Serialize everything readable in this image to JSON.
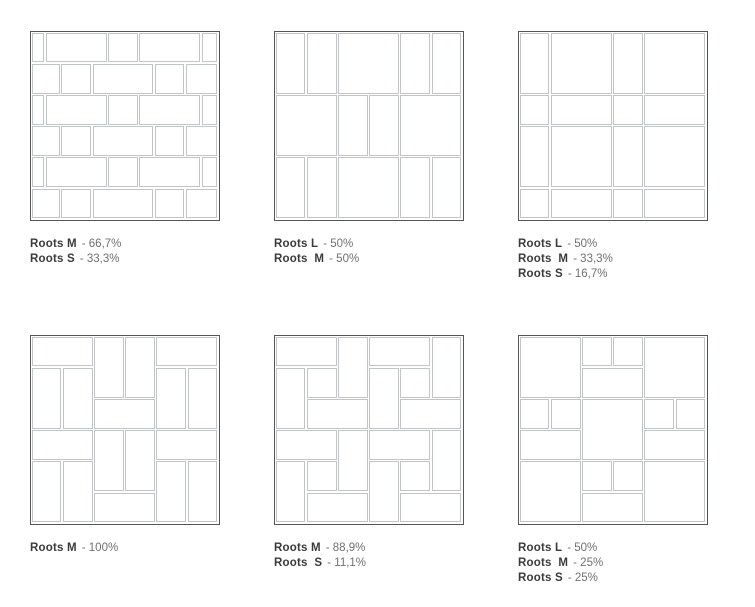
{
  "page": {
    "background": "#ffffff"
  },
  "theme": {
    "box_border_color": "#565656",
    "tile_line_color": "#c1c5c5",
    "tile_fill": "#ffffff",
    "name_color": "#3b3b3b",
    "value_color": "#707070"
  },
  "panels": [
    {
      "id": "pattern-1",
      "labels": [
        {
          "name": "Roots M",
          "value": "- 66,7%"
        },
        {
          "name": "Roots S",
          "value": "- 33,3%"
        }
      ],
      "grid": 6,
      "tiles": [
        [
          0,
          0,
          0.45,
          1
        ],
        [
          0.45,
          0,
          2,
          1
        ],
        [
          2.45,
          0,
          1,
          1
        ],
        [
          3.45,
          0,
          2,
          1
        ],
        [
          5.45,
          0,
          0.55,
          1
        ],
        [
          0,
          1,
          0.95,
          1
        ],
        [
          0.95,
          1,
          1,
          1
        ],
        [
          1.95,
          1,
          2,
          1
        ],
        [
          3.95,
          1,
          1,
          1
        ],
        [
          4.95,
          1,
          1.05,
          1
        ],
        [
          0,
          2,
          0.45,
          1
        ],
        [
          0.45,
          2,
          2,
          1
        ],
        [
          2.45,
          2,
          1,
          1
        ],
        [
          3.45,
          2,
          2,
          1
        ],
        [
          5.45,
          2,
          0.55,
          1
        ],
        [
          0,
          3,
          0.95,
          1
        ],
        [
          0.95,
          3,
          1,
          1
        ],
        [
          1.95,
          3,
          2,
          1
        ],
        [
          3.95,
          3,
          1,
          1
        ],
        [
          4.95,
          3,
          1.05,
          1
        ],
        [
          0,
          4,
          0.45,
          1
        ],
        [
          0.45,
          4,
          2,
          1
        ],
        [
          2.45,
          4,
          1,
          1
        ],
        [
          3.45,
          4,
          2,
          1
        ],
        [
          5.45,
          4,
          0.55,
          1
        ],
        [
          0,
          5,
          0.95,
          1
        ],
        [
          0.95,
          5,
          1,
          1
        ],
        [
          1.95,
          5,
          2,
          1
        ],
        [
          3.95,
          5,
          1,
          1
        ],
        [
          4.95,
          5,
          1.05,
          1
        ]
      ]
    },
    {
      "id": "pattern-2",
      "labels": [
        {
          "name": "Roots L",
          "value": "- 50%"
        },
        {
          "name": "Roots  M",
          "value": "- 50%"
        }
      ],
      "grid": 6,
      "tiles": [
        [
          0,
          0,
          1,
          2
        ],
        [
          1,
          0,
          1,
          2
        ],
        [
          2,
          0,
          2,
          2
        ],
        [
          4,
          0,
          1,
          2
        ],
        [
          5,
          0,
          1,
          2
        ],
        [
          0,
          2,
          2,
          2
        ],
        [
          2,
          2,
          1,
          2
        ],
        [
          3,
          2,
          1,
          2
        ],
        [
          4,
          2,
          2,
          2
        ],
        [
          0,
          4,
          1,
          2
        ],
        [
          1,
          4,
          1,
          2
        ],
        [
          2,
          4,
          2,
          2
        ],
        [
          4,
          4,
          1,
          2
        ],
        [
          5,
          4,
          1,
          2
        ]
      ]
    },
    {
      "id": "pattern-3",
      "labels": [
        {
          "name": "Roots L",
          "value": "- 50%"
        },
        {
          "name": "Roots  M",
          "value": "- 33,3%"
        },
        {
          "name": "Roots S",
          "value": "- 16,7%"
        }
      ],
      "grid": 6,
      "tiles": [
        [
          0,
          0,
          1,
          2
        ],
        [
          1,
          0,
          2,
          2
        ],
        [
          3,
          0,
          1,
          2
        ],
        [
          4,
          0,
          2,
          2
        ],
        [
          0,
          2,
          1,
          1
        ],
        [
          1,
          2,
          2,
          1
        ],
        [
          3,
          2,
          1,
          1
        ],
        [
          4,
          2,
          2,
          1
        ],
        [
          0,
          3,
          1,
          2
        ],
        [
          1,
          3,
          2,
          2
        ],
        [
          3,
          3,
          1,
          2
        ],
        [
          4,
          3,
          2,
          2
        ],
        [
          0,
          5,
          1,
          1
        ],
        [
          1,
          5,
          2,
          1
        ],
        [
          3,
          5,
          1,
          1
        ],
        [
          4,
          5,
          2,
          1
        ]
      ]
    },
    {
      "id": "pattern-4",
      "labels": [
        {
          "name": "Roots M",
          "value": "- 100%"
        }
      ],
      "grid": 6,
      "tiles": [
        [
          0,
          0,
          2,
          1
        ],
        [
          2,
          0,
          1,
          2
        ],
        [
          3,
          0,
          1,
          2
        ],
        [
          4,
          0,
          2,
          1
        ],
        [
          0,
          1,
          1,
          2
        ],
        [
          1,
          1,
          1,
          2
        ],
        [
          4,
          1,
          1,
          2
        ],
        [
          5,
          1,
          1,
          2
        ],
        [
          2,
          2,
          2,
          1
        ],
        [
          0,
          3,
          2,
          1
        ],
        [
          2,
          3,
          1,
          2
        ],
        [
          3,
          3,
          1,
          2
        ],
        [
          4,
          3,
          2,
          1
        ],
        [
          0,
          4,
          1,
          2
        ],
        [
          1,
          4,
          1,
          2
        ],
        [
          4,
          4,
          1,
          2
        ],
        [
          5,
          4,
          1,
          2
        ],
        [
          2,
          5,
          2,
          1
        ]
      ]
    },
    {
      "id": "pattern-5",
      "labels": [
        {
          "name": "Roots M",
          "value": "- 88,9%"
        },
        {
          "name": "Roots  S",
          "value": "- 11,1%"
        }
      ],
      "grid": 6,
      "tiles": [
        [
          0,
          0,
          2,
          1
        ],
        [
          2,
          0,
          1,
          2
        ],
        [
          0,
          1,
          1,
          2
        ],
        [
          1,
          1,
          1,
          1
        ],
        [
          1,
          2,
          2,
          1
        ],
        [
          3,
          0,
          2,
          1
        ],
        [
          5,
          0,
          1,
          2
        ],
        [
          3,
          1,
          1,
          2
        ],
        [
          4,
          1,
          1,
          1
        ],
        [
          4,
          2,
          2,
          1
        ],
        [
          0,
          3,
          2,
          1
        ],
        [
          2,
          3,
          1,
          2
        ],
        [
          0,
          4,
          1,
          2
        ],
        [
          1,
          4,
          1,
          1
        ],
        [
          1,
          5,
          2,
          1
        ],
        [
          3,
          3,
          2,
          1
        ],
        [
          5,
          3,
          1,
          2
        ],
        [
          3,
          4,
          1,
          2
        ],
        [
          4,
          4,
          1,
          1
        ],
        [
          4,
          5,
          2,
          1
        ]
      ]
    },
    {
      "id": "pattern-6",
      "labels": [
        {
          "name": "Roots L",
          "value": "- 50%"
        },
        {
          "name": "Roots  M",
          "value": "- 25%"
        },
        {
          "name": "Roots S",
          "value": "- 25%"
        }
      ],
      "grid": 6,
      "tiles": [
        [
          0,
          0,
          2,
          2
        ],
        [
          2,
          0,
          1,
          1
        ],
        [
          3,
          0,
          1,
          1
        ],
        [
          4,
          0,
          2,
          2
        ],
        [
          2,
          1,
          2,
          1
        ],
        [
          0,
          2,
          1,
          1
        ],
        [
          1,
          2,
          1,
          1
        ],
        [
          2,
          2,
          2,
          2
        ],
        [
          4,
          2,
          1,
          1
        ],
        [
          5,
          2,
          1,
          1
        ],
        [
          0,
          3,
          2,
          1
        ],
        [
          4,
          3,
          2,
          1
        ],
        [
          0,
          4,
          2,
          2
        ],
        [
          2,
          4,
          1,
          1
        ],
        [
          3,
          4,
          1,
          1
        ],
        [
          4,
          4,
          2,
          2
        ],
        [
          2,
          5,
          2,
          1
        ]
      ]
    }
  ]
}
